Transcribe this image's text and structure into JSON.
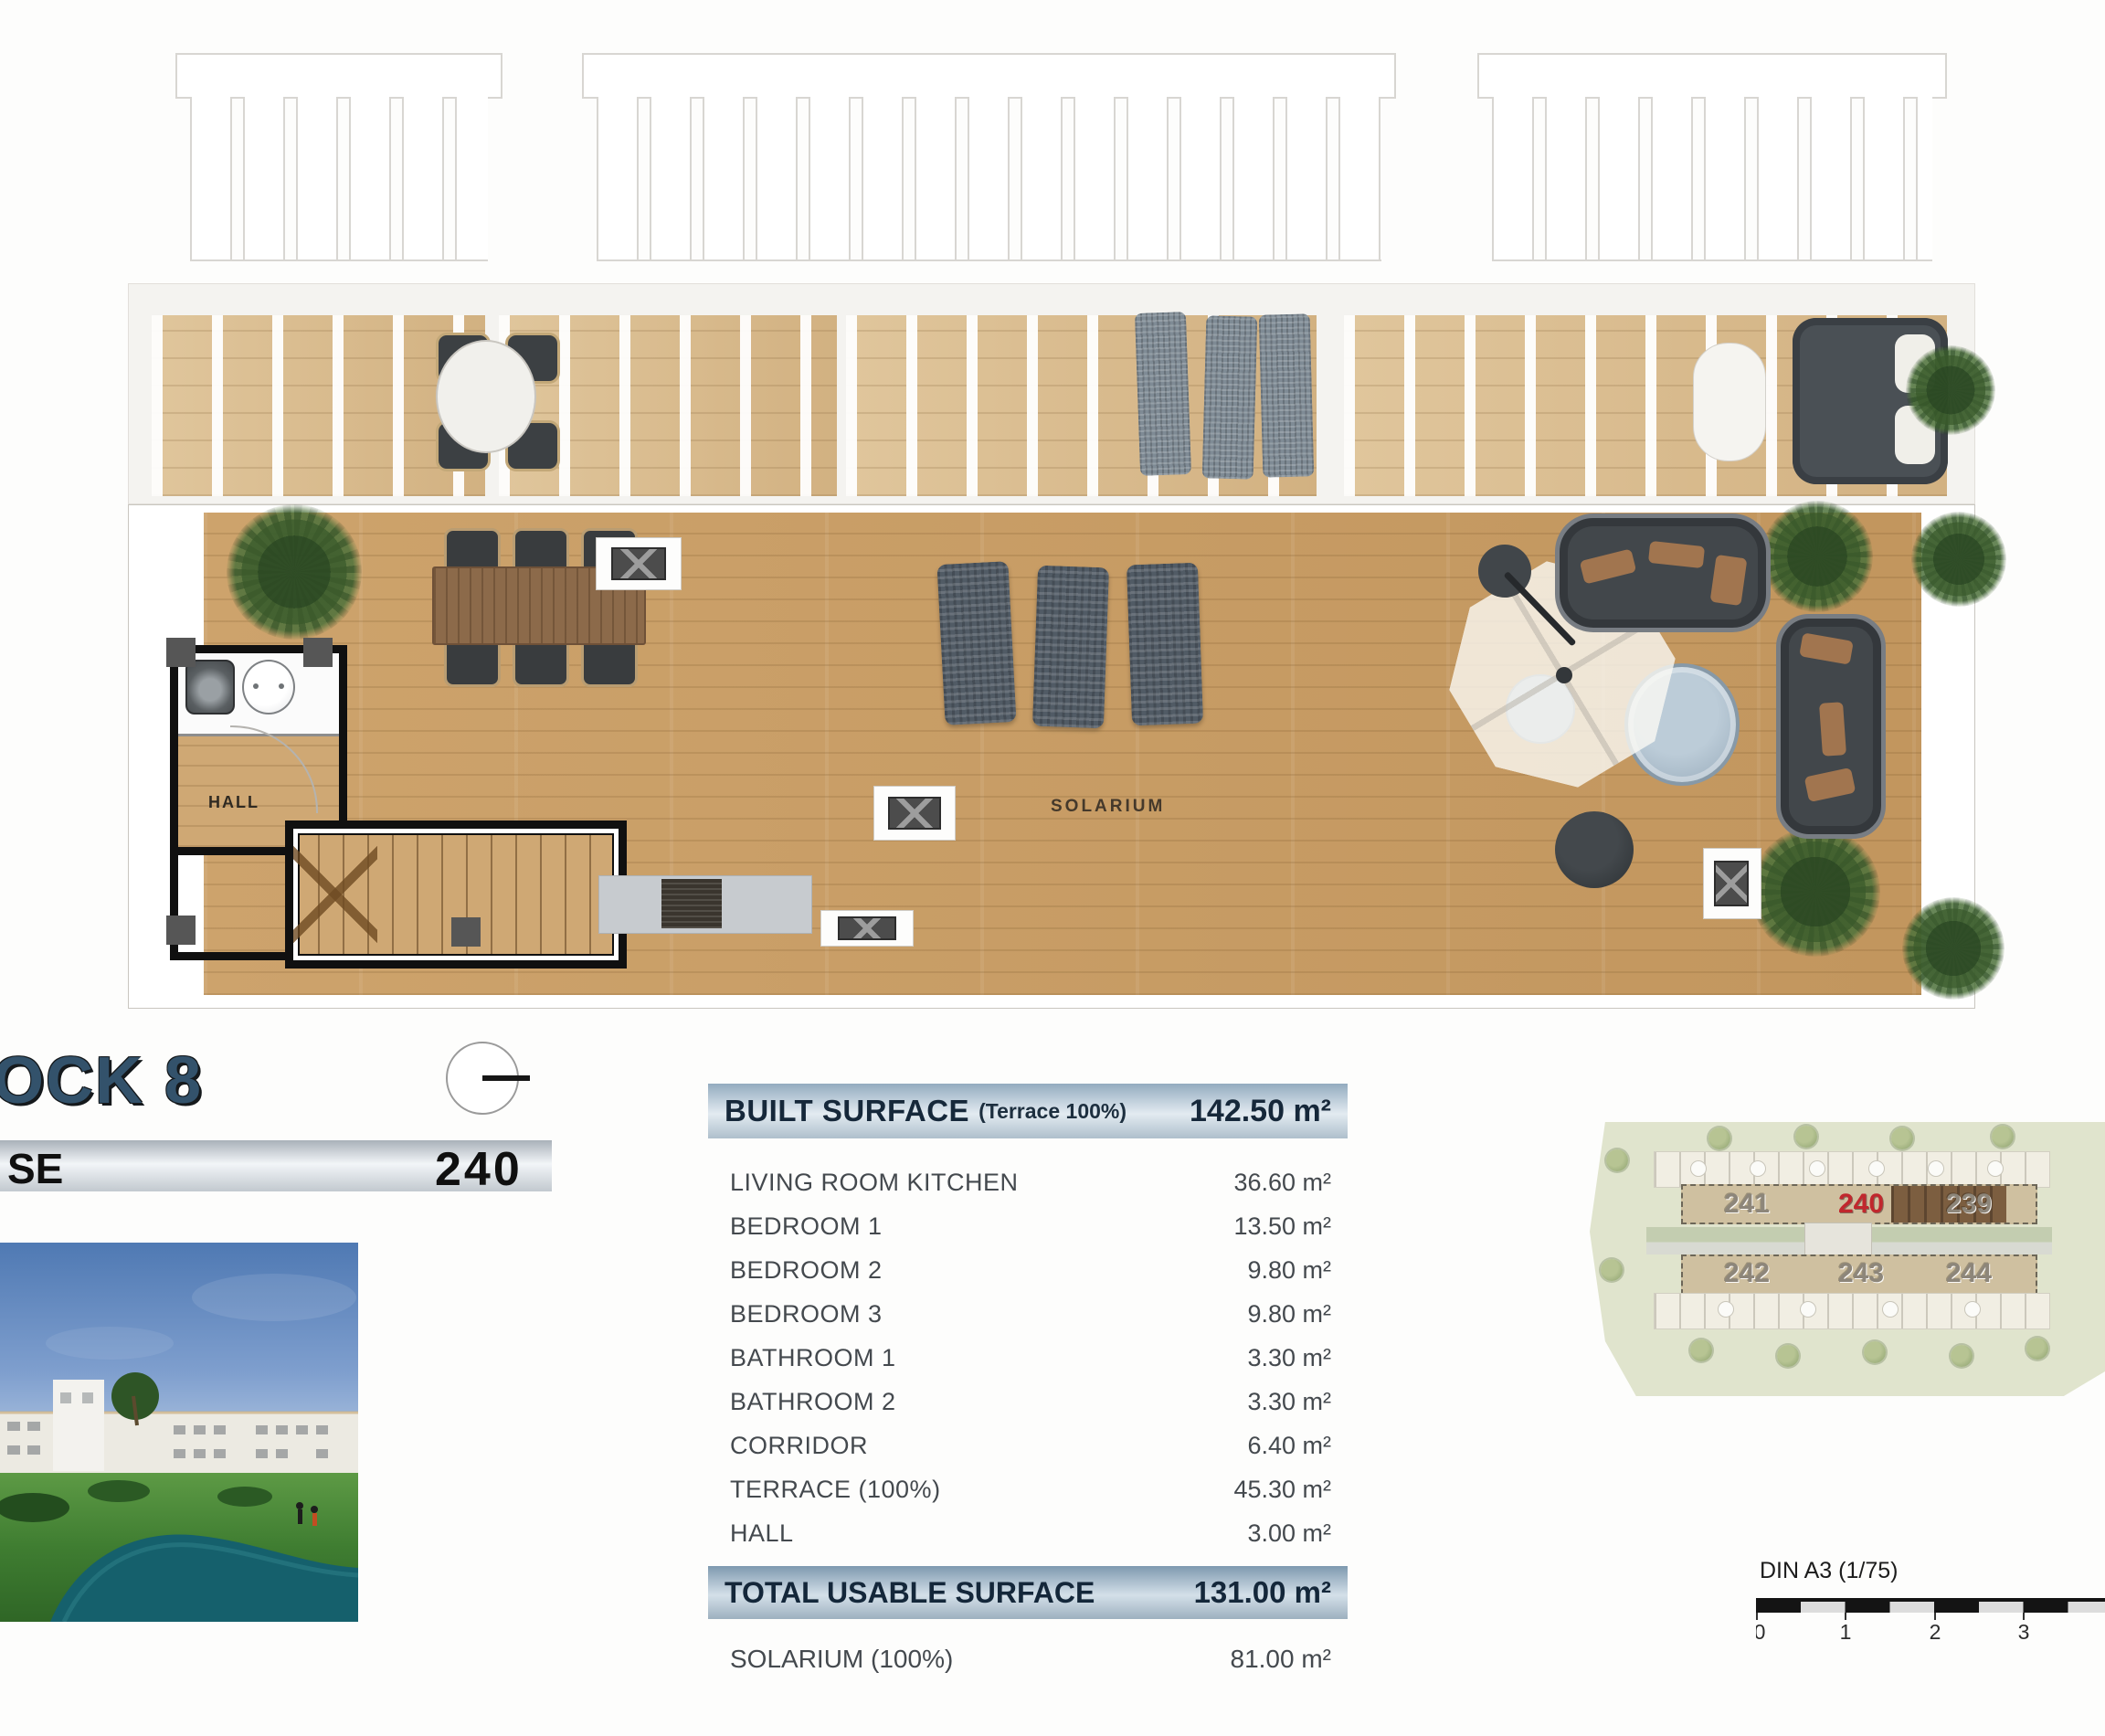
{
  "plan": {
    "solarium_label": "SOLARIUM",
    "hall_label": "HALL"
  },
  "title": {
    "block_title": "OCK 8",
    "unit_bar_label": "SE",
    "unit_number": "240"
  },
  "surface_table": {
    "header": {
      "label": "BUILT SURFACE",
      "sublabel": "(Terrace 100%)",
      "value": "142.50 m²"
    },
    "rows": [
      {
        "label": "LIVING ROOM KITCHEN",
        "value": "36.60 m²"
      },
      {
        "label": "BEDROOM 1",
        "value": "13.50 m²"
      },
      {
        "label": "BEDROOM 2",
        "value": "9.80 m²"
      },
      {
        "label": "BEDROOM 3",
        "value": "9.80 m²"
      },
      {
        "label": "BATHROOM 1",
        "value": "3.30 m²"
      },
      {
        "label": "BATHROOM 2",
        "value": "3.30 m²"
      },
      {
        "label": "CORRIDOR",
        "value": "6.40 m²"
      },
      {
        "label": "TERRACE (100%)",
        "value": "45.30 m²"
      },
      {
        "label": "HALL",
        "value": "3.00 m²"
      }
    ],
    "total": {
      "label": "TOTAL USABLE SURFACE",
      "value": "131.00 m²"
    },
    "solarium_row": {
      "label": "SOLARIUM (100%)",
      "value": "81.00 m²"
    }
  },
  "site_plan": {
    "units_top": [
      "241",
      "240",
      "239"
    ],
    "units_bottom": [
      "242",
      "243",
      "244"
    ],
    "highlighted_unit": "240"
  },
  "scale_bar": {
    "label": "DIN A3 (1/75)",
    "ticks": [
      "0",
      "1",
      "2",
      "3"
    ]
  },
  "colors": {
    "highlight_red": "#c1272d",
    "title_blue": "#33526b",
    "table_header_blue": "#93abbf",
    "deck_wood": "#c89f68",
    "terrace_wood": "#d9bc8e"
  }
}
